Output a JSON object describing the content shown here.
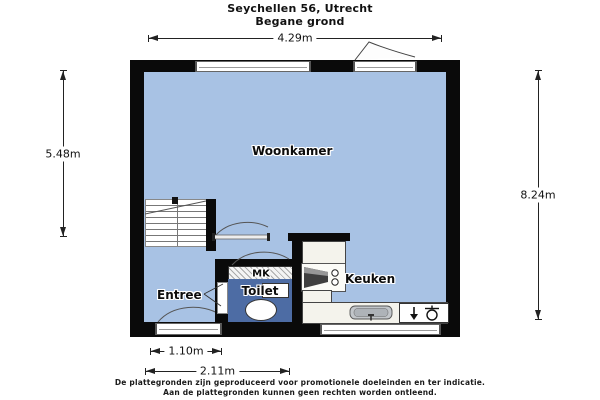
{
  "title": {
    "line1": "Seychellen 56, Utrecht",
    "line2": "Begane grond"
  },
  "rooms": {
    "woonkamer": "Woonkamer",
    "entree": "Entree",
    "mk": "MK",
    "toilet": "Toilet",
    "keuken": "Keuken"
  },
  "dimensions": {
    "width_top": "4.29m",
    "height_left": "5.48m",
    "height_right": "8.24m",
    "door_width": "1.10m",
    "hall_width": "2.11m"
  },
  "fixtures": [
    "stairs",
    "stove",
    "kitchen-sink",
    "boiler",
    "toilet-bowl",
    "hand-basin"
  ],
  "footer": {
    "line1": "De plattegronden zijn geproduceerd voor promotionele doeleinden en ter indicatie.",
    "line2": "Aan de plattegronden kunnen geen rechten worden ontleend."
  },
  "colors": {
    "floor": "#a8c2e4",
    "toilet_floor": "#4d6ca4",
    "wall": "#0a0a0a",
    "counter": "#f4f3ec",
    "background": "#ffffff"
  }
}
